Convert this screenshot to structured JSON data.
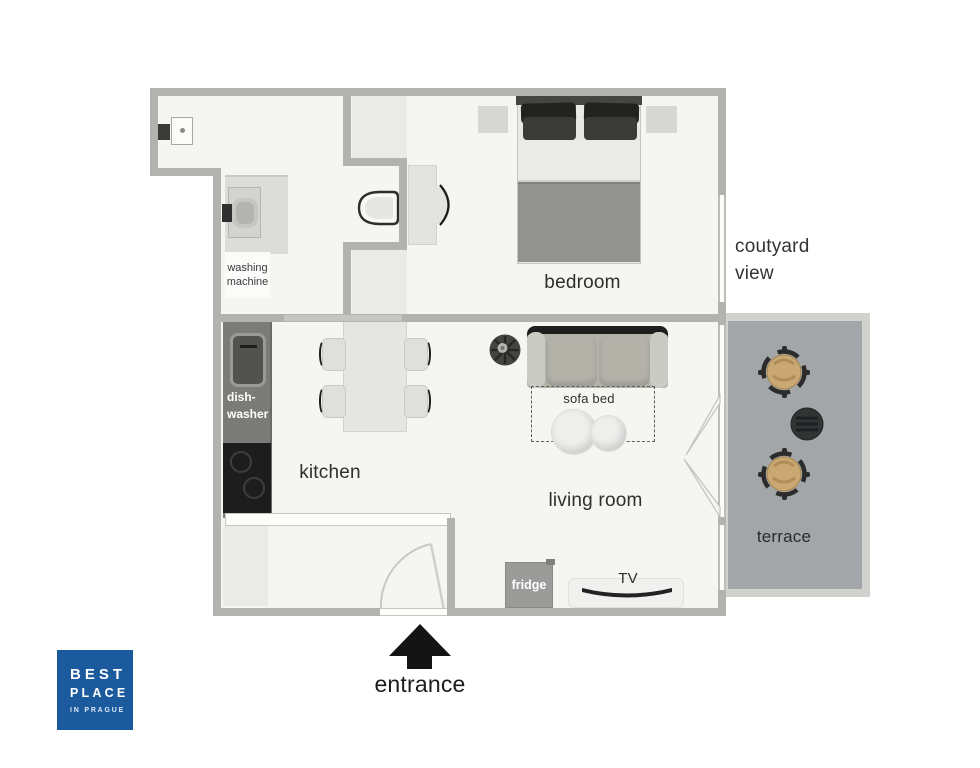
{
  "texts": {
    "bedroom": "bedroom",
    "kitchen": "kitchen",
    "living_room": "living room",
    "terrace": "terrace",
    "courtyard": "coutyard\nview",
    "entrance": "entrance",
    "sofa_bed": "sofa bed",
    "tv": "TV",
    "fridge": "fridge",
    "dishwasher": "dish-\nwasher",
    "washing_machine": "washing\nmachine"
  },
  "logo": {
    "line1": "BEST",
    "line2": "PLACE",
    "line3": "IN PRAGUE"
  },
  "colors": {
    "wall": "#b2b2ae",
    "floor": "#f5f5f1",
    "counter_dark": "#7b7b77",
    "cooktop_black": "#1d1d1d",
    "terrace_floor": "#a3a6a8",
    "sofa_back": "#1e1e1e",
    "rattan_tan": "#c9a873",
    "logo_blue": "#1b5b9d"
  }
}
